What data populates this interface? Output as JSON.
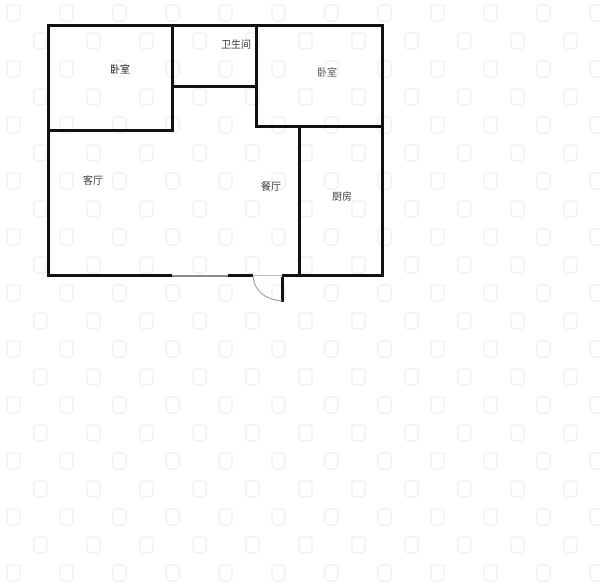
{
  "page": {
    "background_color": "#ffffff",
    "wall_color": "#111111",
    "window_color": "#8a8a8a",
    "door_arc_color": "#999999",
    "watermark_color": "#f4f4f4"
  },
  "floorplan": {
    "rooms": [
      {
        "id": "bedroom-left",
        "label": "卧室"
      },
      {
        "id": "bathroom",
        "label": "卫生间"
      },
      {
        "id": "bedroom-right",
        "label": "卧室"
      },
      {
        "id": "living-room",
        "label": "客厅"
      },
      {
        "id": "dining-room",
        "label": "餐厅"
      },
      {
        "id": "kitchen",
        "label": "厨房"
      }
    ]
  }
}
